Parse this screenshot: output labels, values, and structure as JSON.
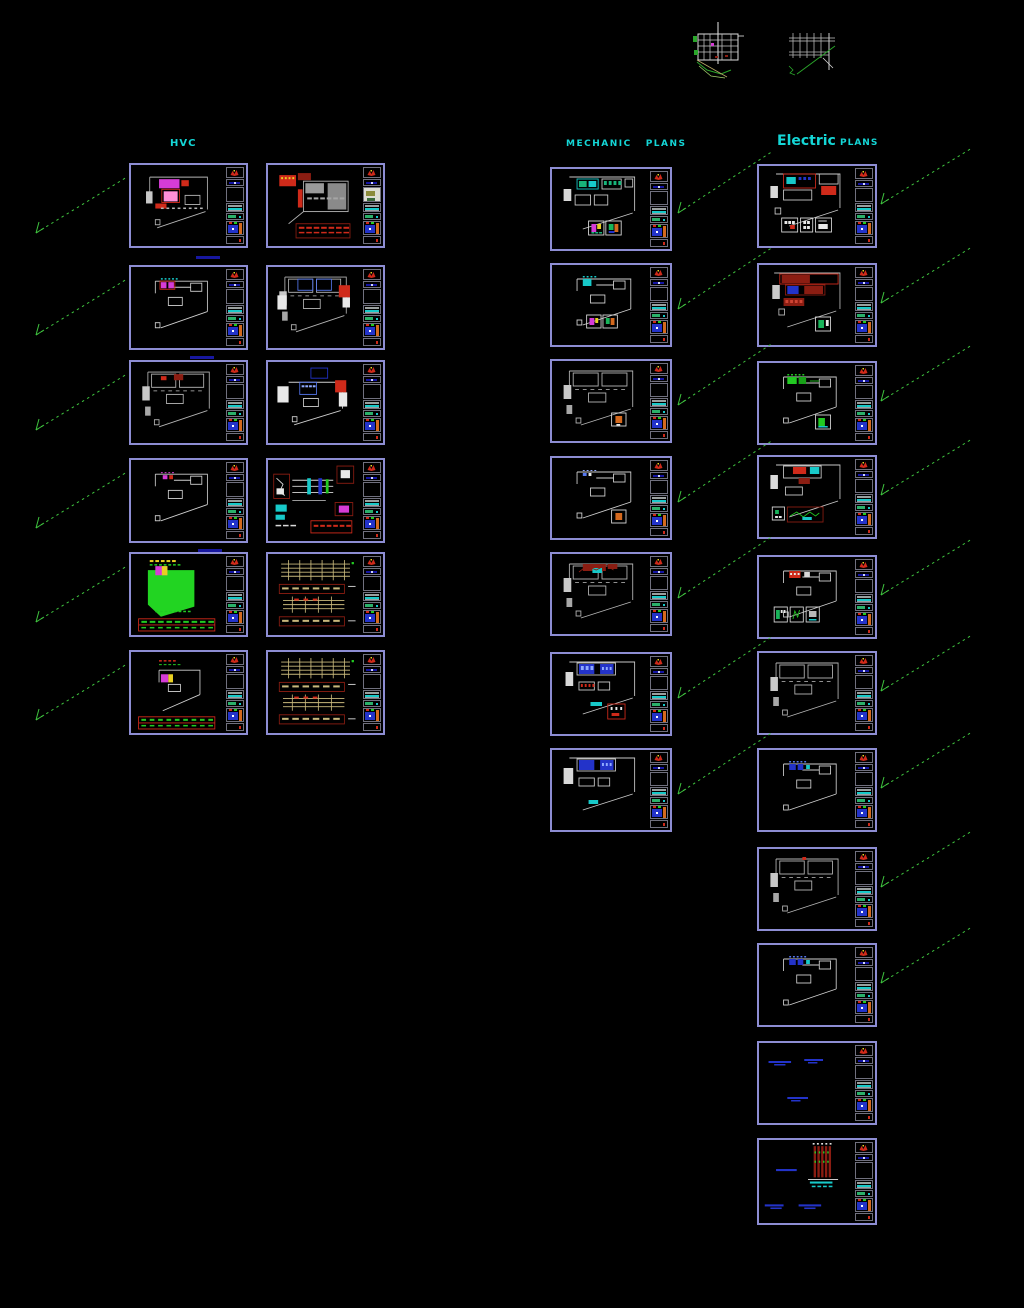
{
  "app": {
    "name": "CAD model space overview"
  },
  "sections": {
    "hvc": {
      "title": "HVC"
    },
    "mechanic": {
      "word1": "MECHANIC",
      "word2": "PLANS"
    },
    "electric": {
      "word1": "Electric",
      "word2": "PLANS"
    }
  },
  "colors": {
    "background": "#000000",
    "sheet_border": "#8d8dd3",
    "section_title": "#14d6d6",
    "leader_green": "#3fc43f",
    "logo_red": "#cf2a1a",
    "note_blue": "#2333c9",
    "highlight_green": "#22d422",
    "highlight_magenta": "#d63cd6",
    "section_tan": "#c9b97c"
  },
  "sheets": [
    {
      "id": "hvc-a1",
      "group": "hvc",
      "col": "a",
      "row": 0,
      "variant": "hvcA1",
      "leader": true
    },
    {
      "id": "hvc-a2",
      "group": "hvc",
      "col": "a",
      "row": 1,
      "variant": "outlineMagenta",
      "leader": true
    },
    {
      "id": "hvc-a3",
      "group": "hvc",
      "col": "a",
      "row": 2,
      "variant": "grayRed",
      "leader": true
    },
    {
      "id": "hvc-a4",
      "group": "hvc",
      "col": "a",
      "row": 3,
      "variant": "outlinePlain",
      "leader": true
    },
    {
      "id": "hvc-a5",
      "group": "hvc",
      "col": "a",
      "row": 4,
      "variant": "greenFill",
      "leader": true
    },
    {
      "id": "hvc-a6",
      "group": "hvc",
      "col": "a",
      "row": 5,
      "variant": "outlineTable",
      "leader": true
    },
    {
      "id": "hvc-b1",
      "group": "hvc",
      "col": "b",
      "row": 0,
      "variant": "redGray",
      "leader": false,
      "thumb": true
    },
    {
      "id": "hvc-b2",
      "group": "hvc",
      "col": "b",
      "row": 1,
      "variant": "grayBlueRed",
      "leader": false
    },
    {
      "id": "hvc-b3",
      "group": "hvc",
      "col": "b",
      "row": 2,
      "variant": "planBlue",
      "leader": false
    },
    {
      "id": "hvc-b4",
      "group": "hvc",
      "col": "b",
      "row": 3,
      "variant": "schematic",
      "leader": false
    },
    {
      "id": "hvc-b5",
      "group": "hvc",
      "col": "b",
      "row": 4,
      "variant": "sectionsTan",
      "leader": false
    },
    {
      "id": "hvc-b6",
      "group": "hvc",
      "col": "b",
      "row": 5,
      "variant": "sectionsTan",
      "leader": false
    },
    {
      "id": "mech-1",
      "group": "mech",
      "row": 0,
      "variant": "mechTeal",
      "leader": true
    },
    {
      "id": "mech-2",
      "group": "mech",
      "row": 1,
      "variant": "outlineTealDetails",
      "leader": true
    },
    {
      "id": "mech-3",
      "group": "mech",
      "row": 2,
      "variant": "grayBox",
      "leader": true
    },
    {
      "id": "mech-4",
      "group": "mech",
      "row": 3,
      "variant": "outlineBox",
      "leader": true
    },
    {
      "id": "mech-5",
      "group": "mech",
      "row": 4,
      "variant": "darkRed",
      "leader": true
    },
    {
      "id": "mech-6",
      "group": "mech",
      "row": 5,
      "variant": "blueDetail",
      "leader": true
    },
    {
      "id": "mech-7",
      "group": "mech",
      "row": 6,
      "variant": "blue2",
      "leader": true
    },
    {
      "id": "elec-1",
      "group": "elec",
      "row": 0,
      "variant": "elecRedDetails",
      "leader": true
    },
    {
      "id": "elec-2",
      "group": "elec",
      "row": 1,
      "variant": "darkRedDetail",
      "leader": true
    },
    {
      "id": "elec-3",
      "group": "elec",
      "row": 2,
      "variant": "outlineGreenDetail",
      "leader": true
    },
    {
      "id": "elec-4",
      "group": "elec",
      "row": 3,
      "variant": "redWave",
      "leader": true
    },
    {
      "id": "elec-5",
      "group": "elec",
      "row": 4,
      "variant": "outline3Details",
      "leader": true
    },
    {
      "id": "elec-6",
      "group": "elec",
      "row": 5,
      "variant": "gray2",
      "leader": true
    },
    {
      "id": "elec-7",
      "group": "elec",
      "row": 6,
      "variant": "outlineBlue",
      "leader": true
    },
    {
      "id": "elec-8",
      "group": "elec",
      "row": 7,
      "variant": "gray3",
      "leader": true
    },
    {
      "id": "elec-9",
      "group": "elec",
      "row": 8,
      "variant": "outlineBlue",
      "leader": true
    },
    {
      "id": "elec-10",
      "group": "elec",
      "row": 9,
      "variant": "notes",
      "leader": false
    },
    {
      "id": "elec-11",
      "group": "elec",
      "row": 10,
      "variant": "notesPole",
      "leader": false
    }
  ]
}
